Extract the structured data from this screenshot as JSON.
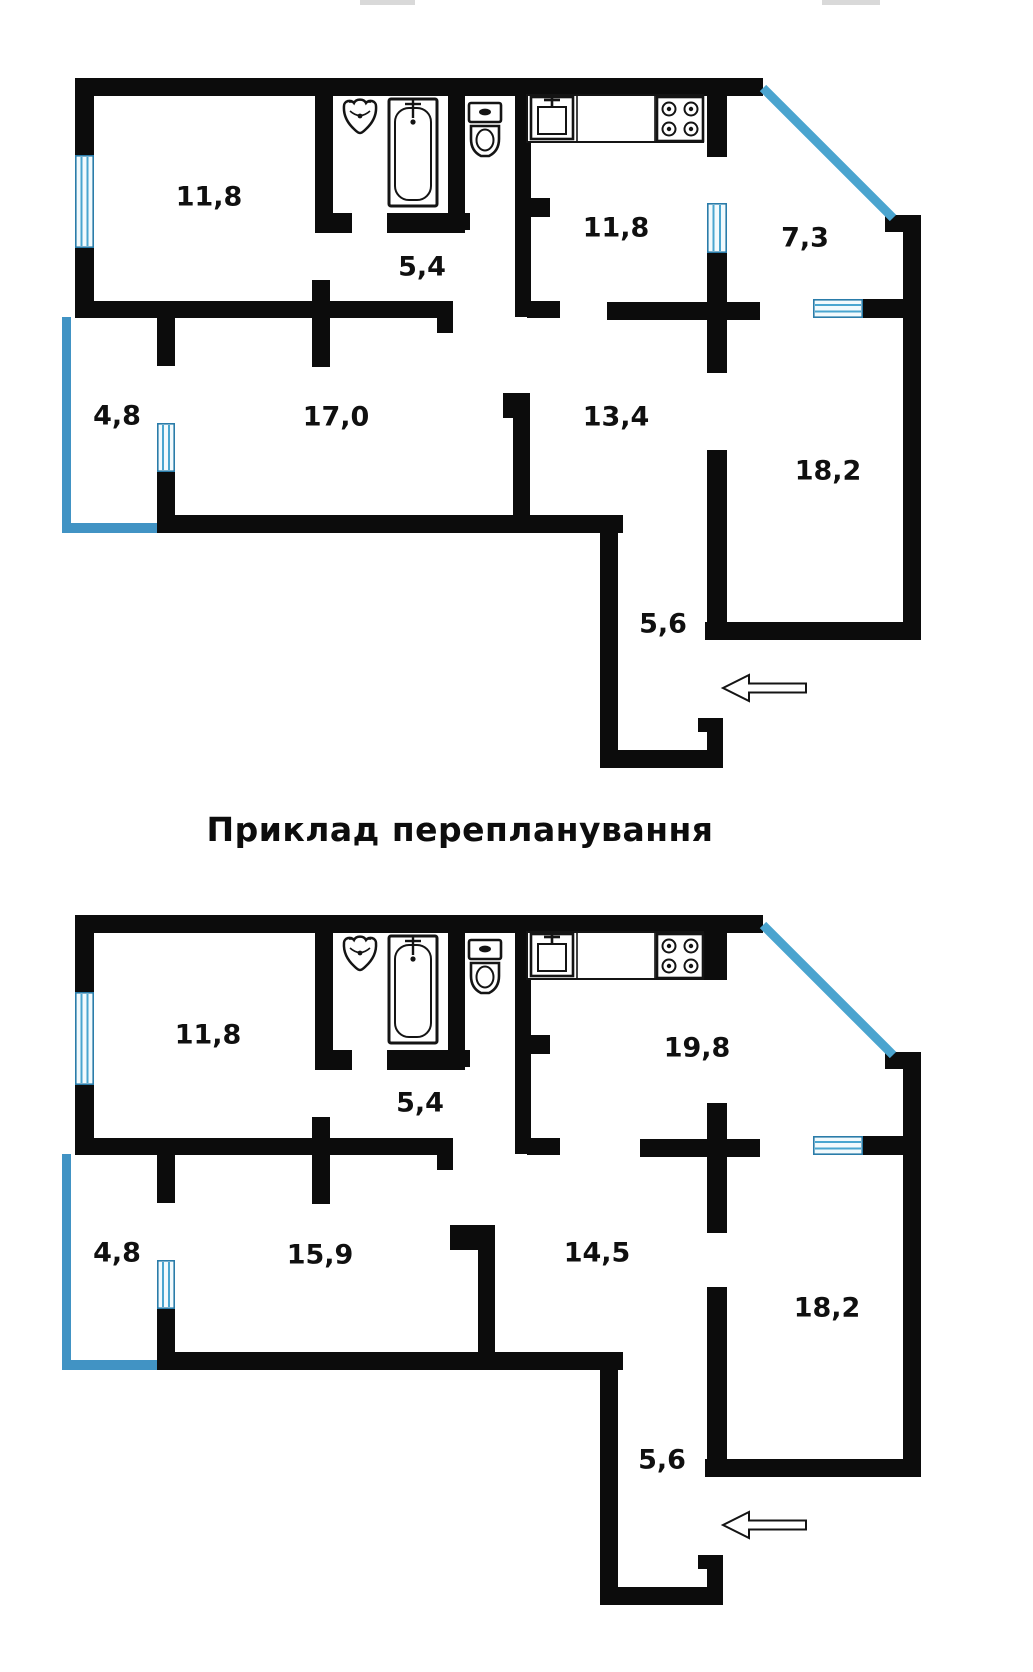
{
  "title": "Приклад перепланування",
  "plans": {
    "original": {
      "name": "original-layout",
      "rooms": {
        "living": "11,8",
        "corridor_small": "5,4",
        "kitchen": "11,8",
        "balcony_right": "7,3",
        "balcony_left": "4,8",
        "bedroom": "17,0",
        "hallway": "13,4",
        "room_large": "18,2",
        "entry": "5,6"
      }
    },
    "replanned": {
      "name": "replanned-layout",
      "rooms": {
        "living": "11,8",
        "corridor_small": "5,4",
        "kitchen_combined": "19,8",
        "balcony_left": "4,8",
        "bedroom": "15,9",
        "hallway": "14,5",
        "room_large": "18,2",
        "entry": "5,6"
      }
    }
  },
  "icons": [
    "washbasin-icon",
    "bathtub-icon",
    "toilet-icon",
    "kitchen-sink-icon",
    "stove-icon",
    "window-icon",
    "entrance-arrow"
  ],
  "colors": {
    "wall": "#0c0c0c",
    "glazing_blue": "#4aa4cf",
    "window_border": "#2a7ca9",
    "window_stripe": "#4aa6d0",
    "balcony_outline": "#4193c4",
    "background": "#ffffff",
    "text": "#101010"
  }
}
